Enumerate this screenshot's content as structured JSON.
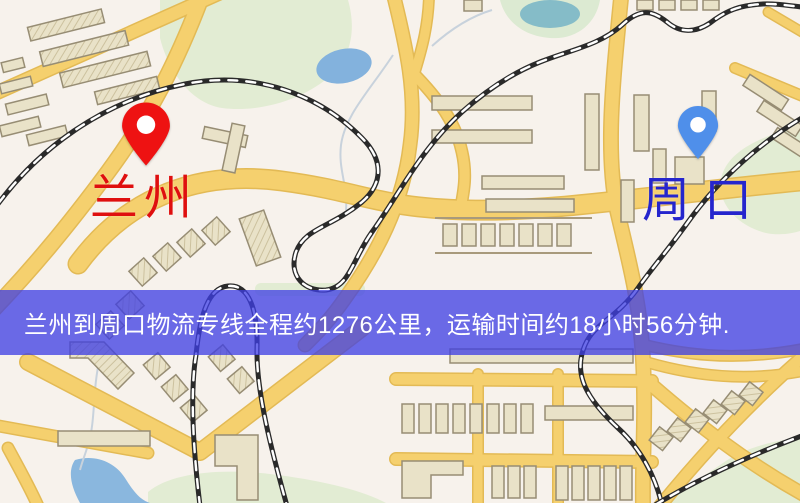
{
  "map": {
    "markers": [
      {
        "id": "origin",
        "label": "兰州",
        "label_color": "#df0f0f",
        "pin_color": "#ee1212"
      },
      {
        "id": "destination",
        "label": "周口",
        "label_color": "#2525cd",
        "pin_color": "#4f8fea"
      }
    ],
    "banner": {
      "text": "兰州到周口物流专线全程约1276公里，运输时间约18小时56分钟.",
      "background": "rgba(62,62,228,0.76)",
      "text_color": "#ffffff"
    },
    "route": {
      "origin": "兰州",
      "destination": "周口",
      "distance": "约1276公里",
      "duration": "约18小时56分钟"
    }
  }
}
